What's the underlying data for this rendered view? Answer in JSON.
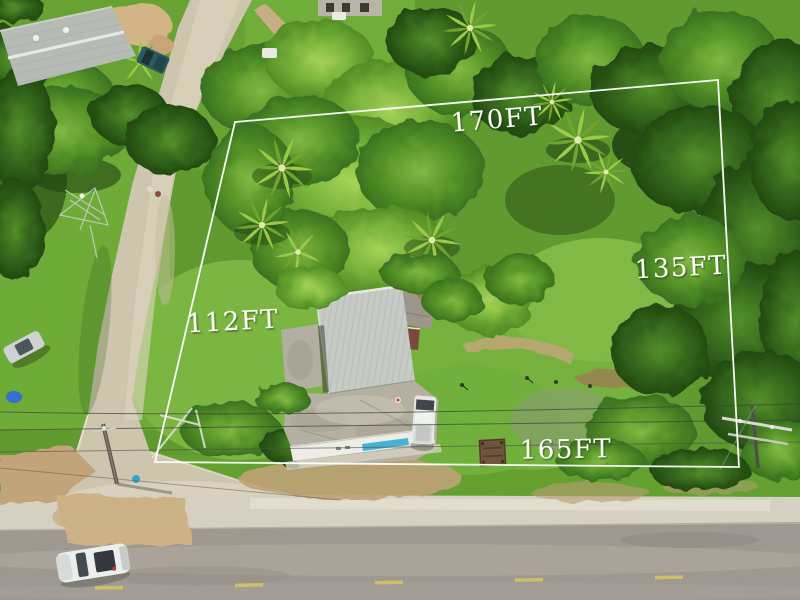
{
  "overlay": {
    "boundary_color": "#ffffff",
    "label_color": "#fdfdf8",
    "labels": {
      "top": "170FT",
      "right": "135FT",
      "left": "112FT",
      "bottom": "165FT"
    }
  },
  "scene": {
    "colors": {
      "canopy_bright": "#8cc63f",
      "canopy_mid": "#559420",
      "canopy_dark": "#2f6414",
      "grass": "#5d9a2b",
      "lawn_bright": "#7ab63e",
      "concrete_side_road": "#cfc6ae",
      "sidewalk": "#d7d2c2",
      "asphalt": "#9d9890",
      "dirt": "#c6a87c",
      "lane_marking": "#cfc163",
      "roof_main_house": "#c7ccc7",
      "roof_warehouse": "#b6bcb5",
      "roof_rust": "#9b968a",
      "shop_stripe_blue": "#3fb4d8",
      "pickup_white": "#e9ebe8",
      "car_white": "#eef0ed",
      "truck_teal": "#27565a",
      "tarp_blue": "#2f6fd0"
    }
  }
}
